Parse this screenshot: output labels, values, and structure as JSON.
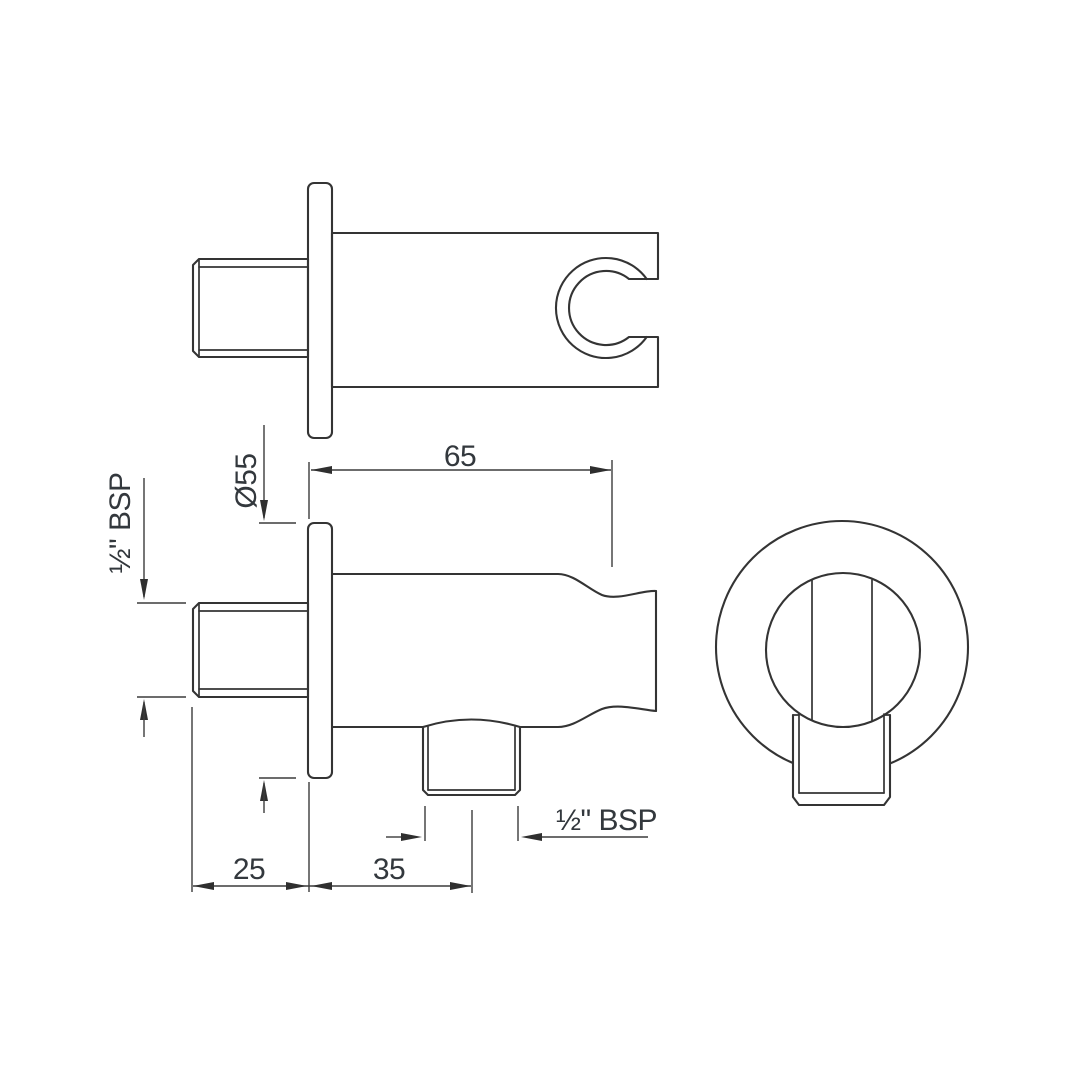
{
  "drawing": {
    "background": "#ffffff",
    "line_color": "#343434",
    "dimension_color": "#3c3c3c",
    "text_color": "#33383d",
    "labels": {
      "flange_diameter": "Ø55",
      "inlet_thread": "½\" BSP",
      "body_length": "65",
      "wall_depth": "25",
      "outlet_offset": "35",
      "outlet_thread": "½\" BSP"
    }
  }
}
